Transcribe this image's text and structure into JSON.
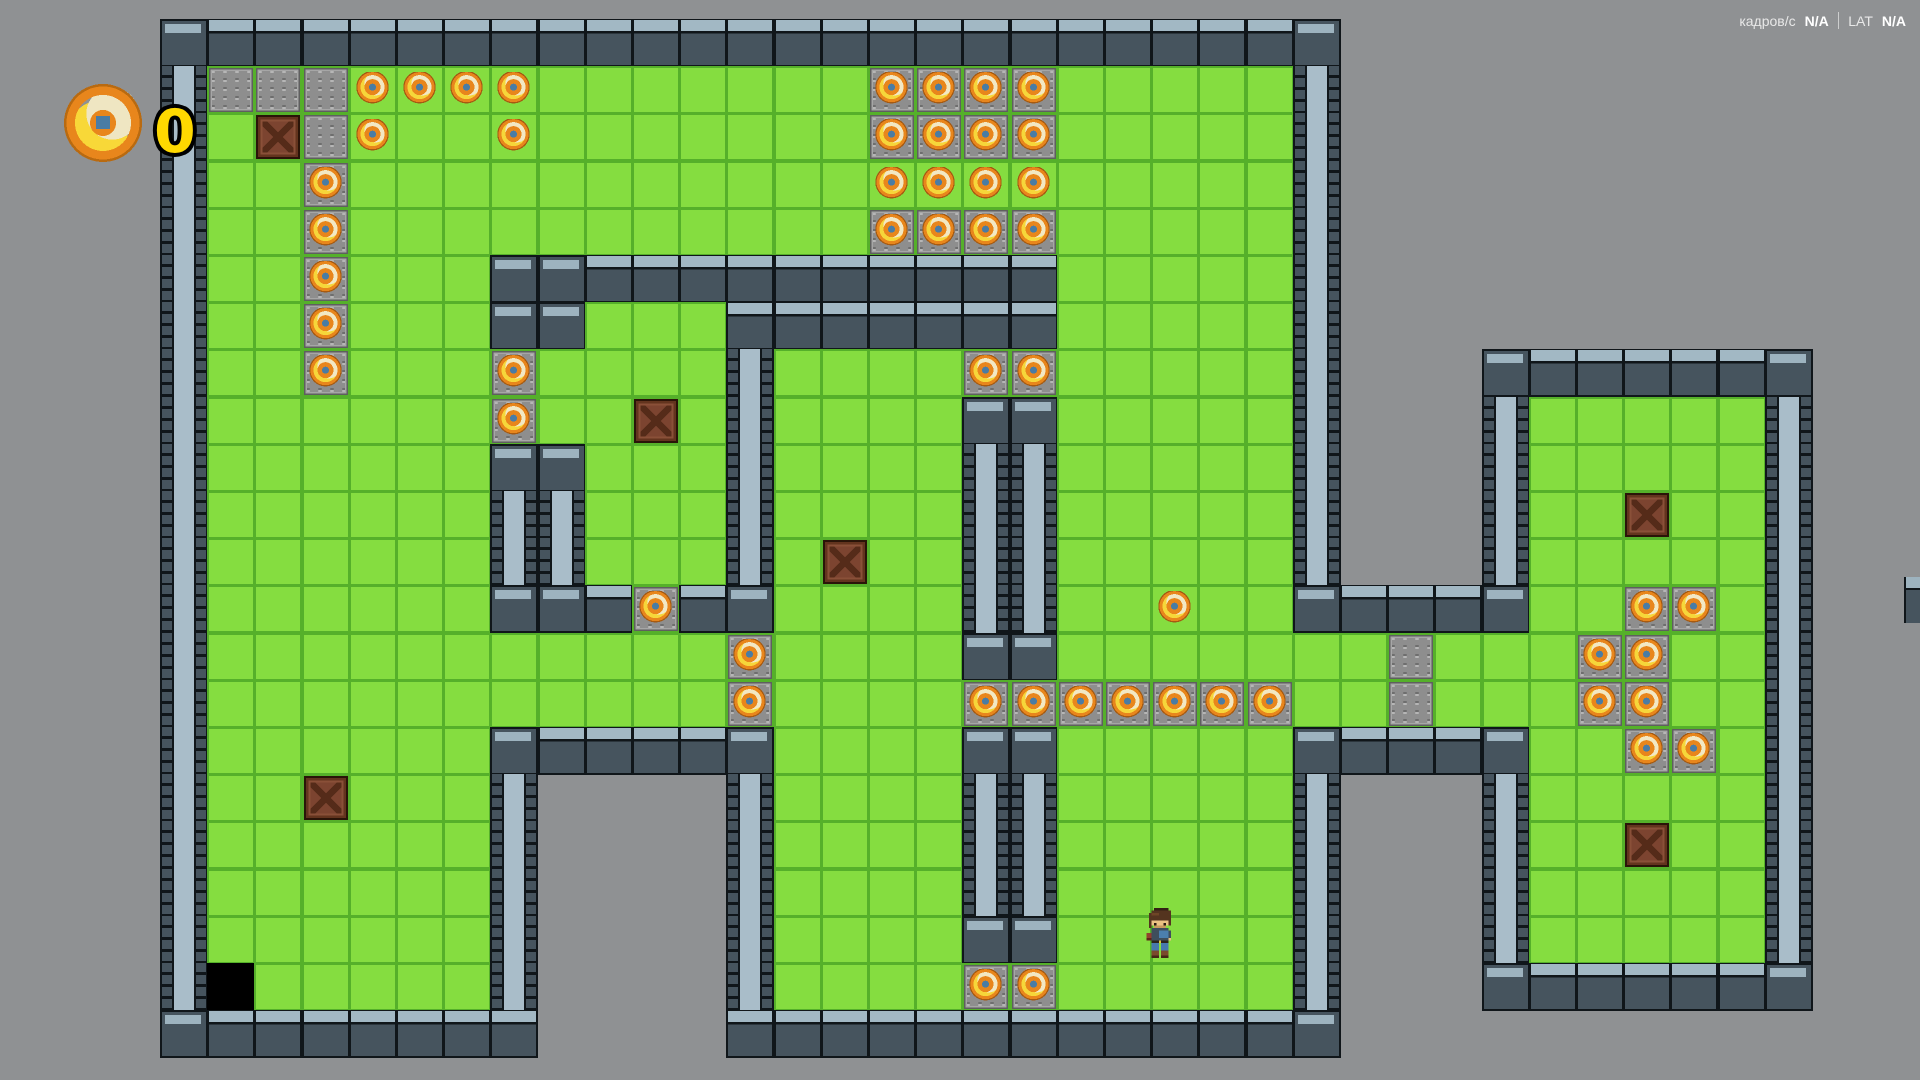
{
  "hud": {
    "fps_label": "кадров/с",
    "fps_value": "N/A",
    "divider": "|",
    "lat_label": "LAT",
    "lat_value": "N/A"
  },
  "collectible_counter": {
    "icon": "coin-icon",
    "value": "0"
  },
  "player": {
    "col": 21,
    "row": 19,
    "facing": "down"
  },
  "palette": {
    "background": "#8f9193",
    "grass": "#85dd40",
    "grass_line": "#55b02a",
    "wall_dark": "#46545e",
    "wall_light": "#a2b8c4",
    "gravel": "#8e8e8e",
    "crate": "#7c4430",
    "coin_orange": "#e8861c",
    "coin_cream": "#f2e8c4",
    "coin_yellow": "#f6d63a",
    "coin_center_blue": "#4a7ca4",
    "counter_yellow": "#ffd900"
  },
  "map": {
    "origin_x": 160,
    "origin_y": 19,
    "tile_size": 47.2,
    "columns": 35,
    "row_count": 22,
    "legend": {
      ".": "empty",
      "G": "grass-tile",
      "D": "gravel-plate-tile",
      "T": "wall-brick-tile",
      "B": "wall-block-tile",
      "V": "wall-pillar-tile",
      "K": "black-pit-tile",
      "X": "crate",
      "c": "coin-on-grass",
      "C": "coin-on-gravel"
    },
    "rows": [
      "BTTTTTTTTTTTTTTTTTTTTTTTB..........",
      "VDDDccccGGGGGGGCCCCGGGGGV..........",
      "VGXDcGGcGGGGGGGCCCCGGGGGV..........",
      "VGGCGGGGGGGGGGGccccGGGGGV..........",
      "VGGCGGGGGGGGGGGCCCCGGGGGV..........",
      "VGGCGGGBBTTTTTTTTTTGGGGGV..........",
      "VGGCGGGBBGGGTTTTTTTGGGGGV..........",
      "VGGCGGGCGGGGVGGGGCCGGGGGV...BTTTTTB",
      "VGGGGGGCGGXGVGGGGBBGGGGGV...VGGGGGV",
      "VGGGGGGBBGGGVGGGGVVGGGGGV...VGGGGGV",
      "VGGGGGGVVGGGVGGGGVVGGGGGV...VGGXGGV",
      "VGGGGGGVVGGGVGXGGVVGGGGGV...VGGGGGV",
      "VGGGGGGBBTCTBGGGGVVGGcGGBTTTBGGCCGV",
      "VGGGGGGGGGGGCGGGGBBGGGGGGGDGGGCCGGV",
      "VGGGGGGGGGGGCGGGGCCCCCCCGGDGGGCCGGV",
      "VGGGGGGBTTTTBGGGGBBGGGGGBTTTBGGCCGV",
      "VGGXGGGV....VGGGGVVGGGGGV...VGGGGGV",
      "VGGGGGGV....VGGGGVVGGGGGV...VGGXGGV",
      "VGGGGGGV....VGGGGVVGGGGGV...VGGGGGV",
      "VGGGGGGV....VGGGGBBGGGGGV...VGGGGGV",
      "VKGGGGGV....VGGGGCCGGGGGV...BTTTTTB",
      "BTTTTTTT....TTTTTTTTTTTTB.........."
    ]
  }
}
